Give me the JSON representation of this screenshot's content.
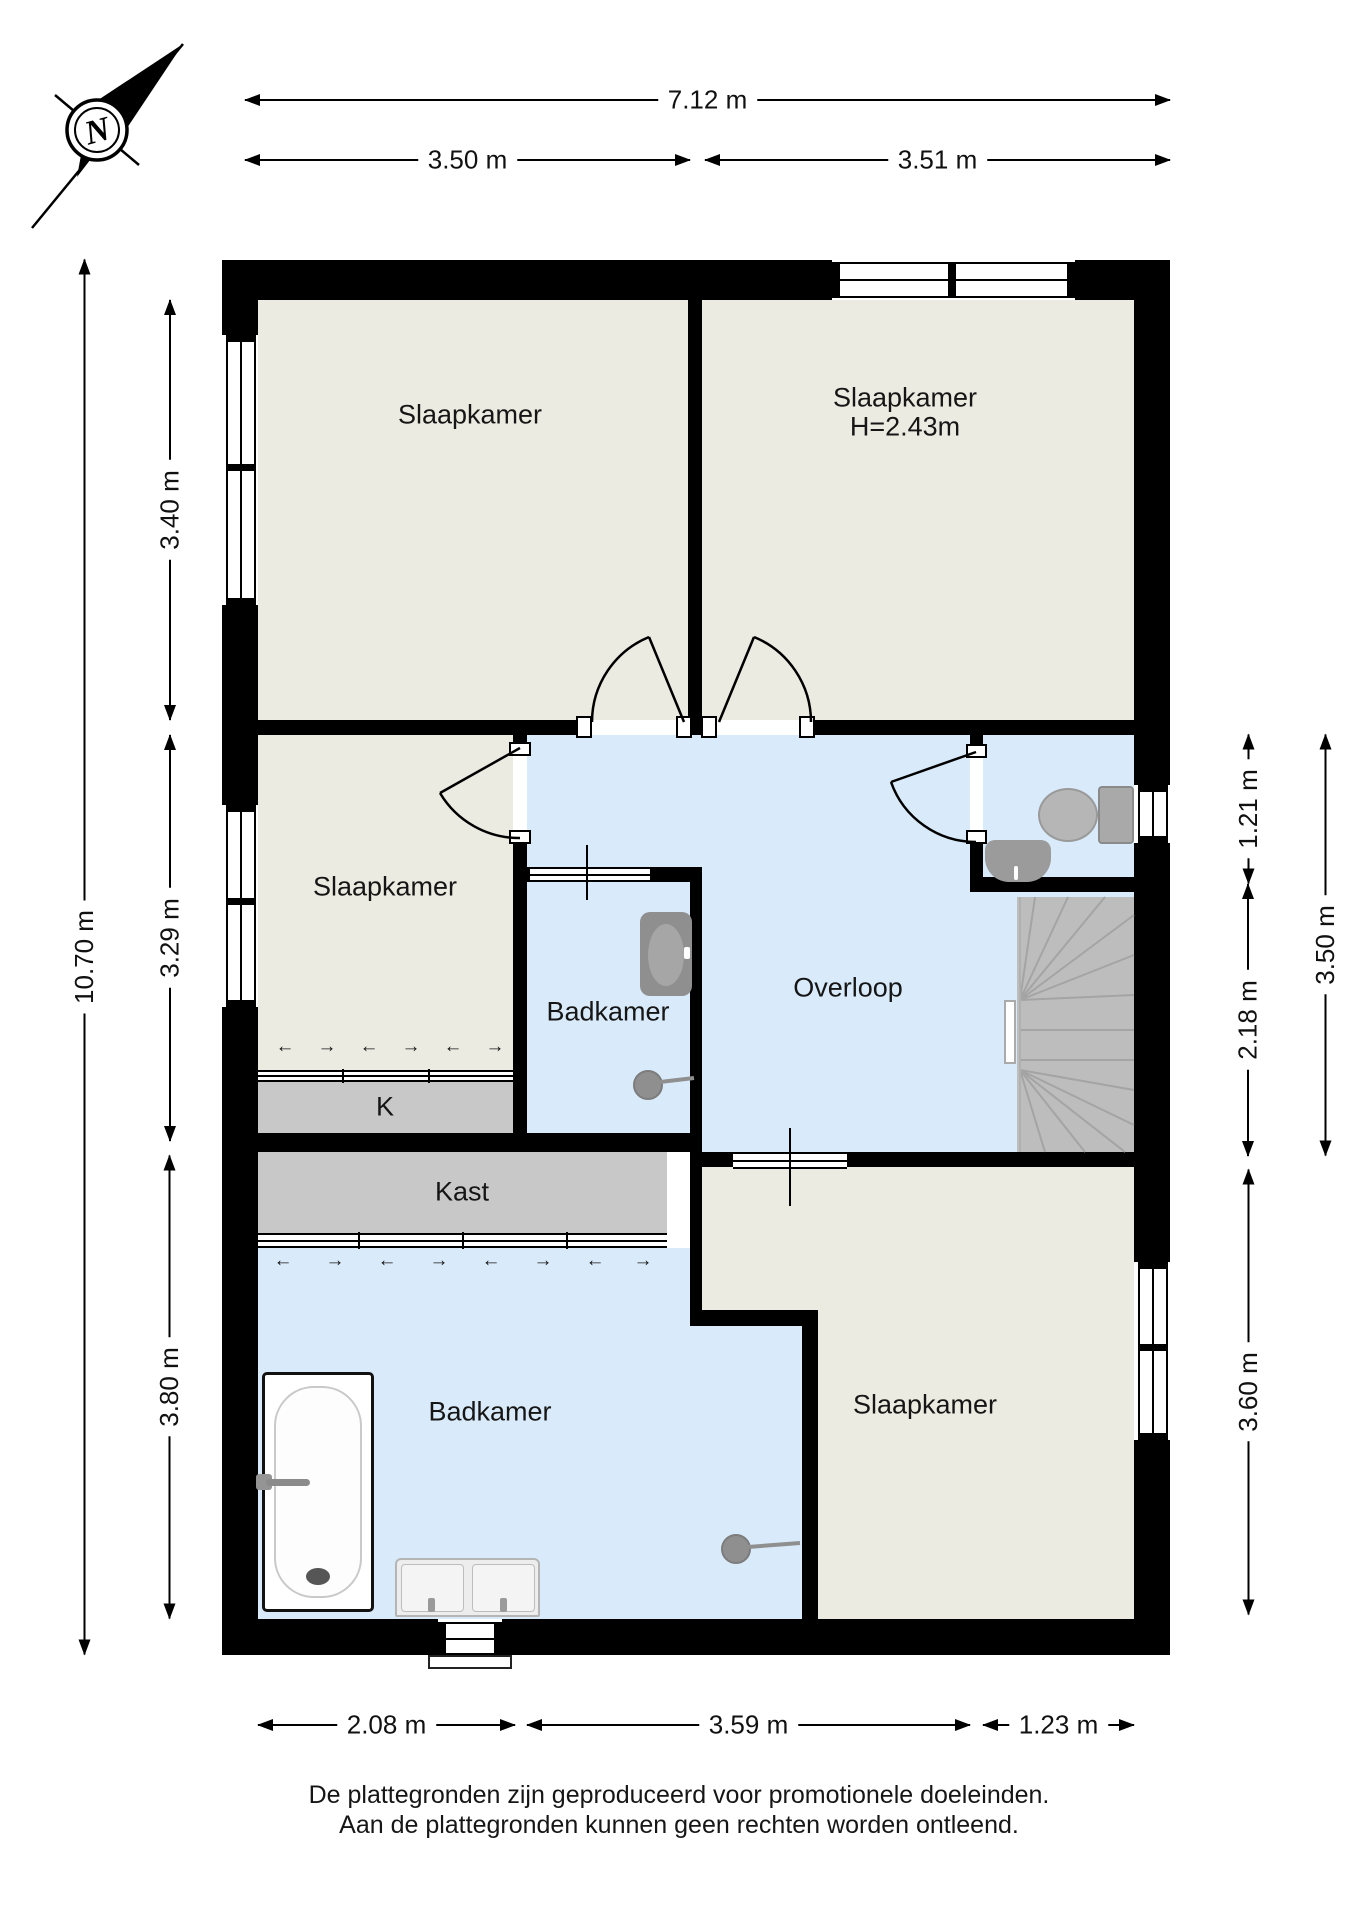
{
  "compass": {
    "label": "N"
  },
  "rooms": {
    "bedroom_top_left": {
      "label": "Slaapkamer"
    },
    "bedroom_top_right": {
      "label": "Slaapkamer",
      "ceiling_height": "H=2.43m"
    },
    "bedroom_middle_left": {
      "label": "Slaapkamer"
    },
    "bathroom_middle": {
      "label": "Badkamer"
    },
    "landing": {
      "label": "Overloop"
    },
    "closet_small": {
      "label": "K"
    },
    "closet_large": {
      "label": "Kast"
    },
    "bathroom_bottom": {
      "label": "Badkamer"
    },
    "bedroom_bottom_right": {
      "label": "Slaapkamer"
    }
  },
  "dimensions": {
    "top_total": "7.12 m",
    "top_left": "3.50 m",
    "top_right": "3.51 m",
    "left_total": "10.70 m",
    "left_top": "3.40 m",
    "left_middle": "3.29 m",
    "left_bottom": "3.80 m",
    "right_toilet": "1.21 m",
    "right_stairs": "2.18 m",
    "right_middle_total": "3.50 m",
    "right_bottom": "3.60 m",
    "bottom_left": "2.08 m",
    "bottom_middle": "3.59 m",
    "bottom_right": "1.23 m"
  },
  "glyphs": {
    "slide_left": "←",
    "slide_right": "→"
  },
  "footer": {
    "line1": "De plattegronden zijn geproduceerd voor promotionele doeleinden.",
    "line2": "Aan de plattegronden kunnen geen rechten worden ontleend."
  },
  "colors": {
    "wall": "#000000",
    "room": "#ecebe1",
    "hall": "#d9ebfa",
    "closet": "#c8c8c8",
    "stairs": "#bdbdbd",
    "fixture": "#8f8f8f",
    "text": "#161616"
  }
}
